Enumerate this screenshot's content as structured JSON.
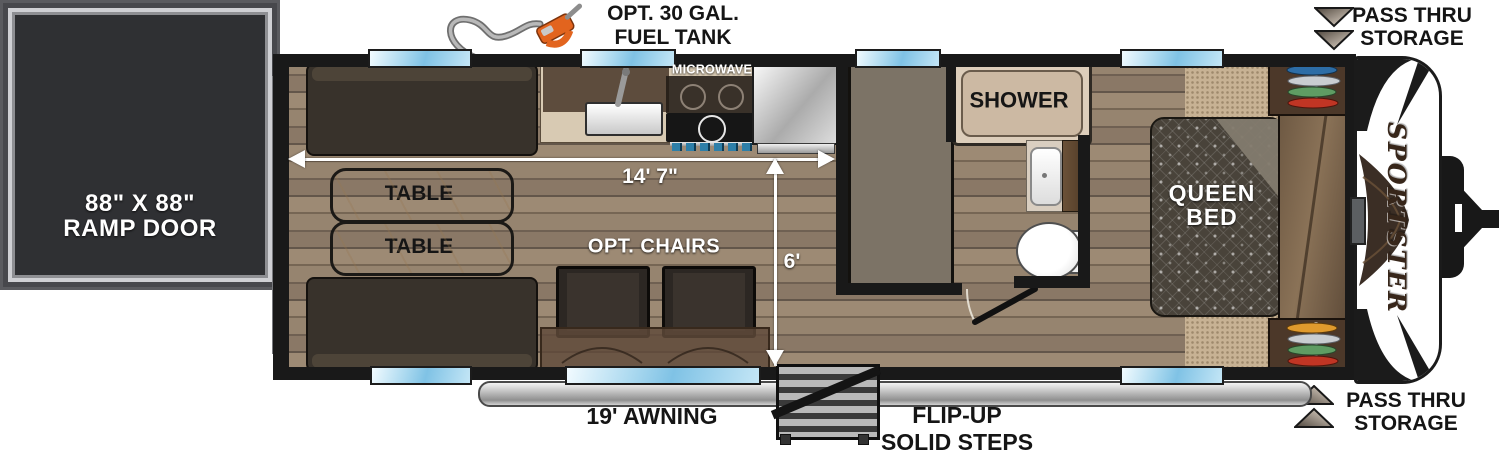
{
  "floorplan": {
    "brand": "SPORTSTER",
    "ramp_door": {
      "line1": "88\" X 88\"",
      "line2": "RAMP DOOR"
    },
    "fuel_tank": {
      "line1": "OPT. 30 GAL.",
      "line2": "FUEL TANK"
    },
    "pass_thru_top": {
      "line1": "PASS THRU",
      "line2": "STORAGE"
    },
    "pass_thru_bottom": {
      "line1": "PASS THRU",
      "line2": "STORAGE"
    },
    "sofa_top": "70\" ROLL-OVER SOFA",
    "sofa_bottom": "70\" ROLL-OVER SOFA",
    "table_upper": "TABLE",
    "table_lower": "TABLE",
    "microwave": "MICROWAVE",
    "refrig_tv": {
      "line1": "REFRIG",
      "line2": "TV"
    },
    "opt_chairs": "OPT. CHAIRS",
    "bunk": {
      "line1": "32\" X 70\"",
      "line2": "BUNK"
    },
    "shower": "SHOWER",
    "queen_bed": {
      "line1": "QUEEN",
      "line2": "BED"
    },
    "awning": "19' AWNING",
    "steps": {
      "line1": "FLIP-UP",
      "line2": "SOLID STEPS"
    },
    "dim_length": "14' 7\"",
    "dim_width": "6'"
  },
  "colors": {
    "wall_black": "#191919",
    "window_blue": "#7fc2e5",
    "sofa_dark_brown": "#38322b",
    "table_marble": "#f0e8d9",
    "bunk_taupe": "#7c7366",
    "shower_beige": "#ddcebb",
    "fuel_nozzle_orange": "#e2641e",
    "annotation_text": "#151515",
    "dimension_white": "#ffffff"
  }
}
